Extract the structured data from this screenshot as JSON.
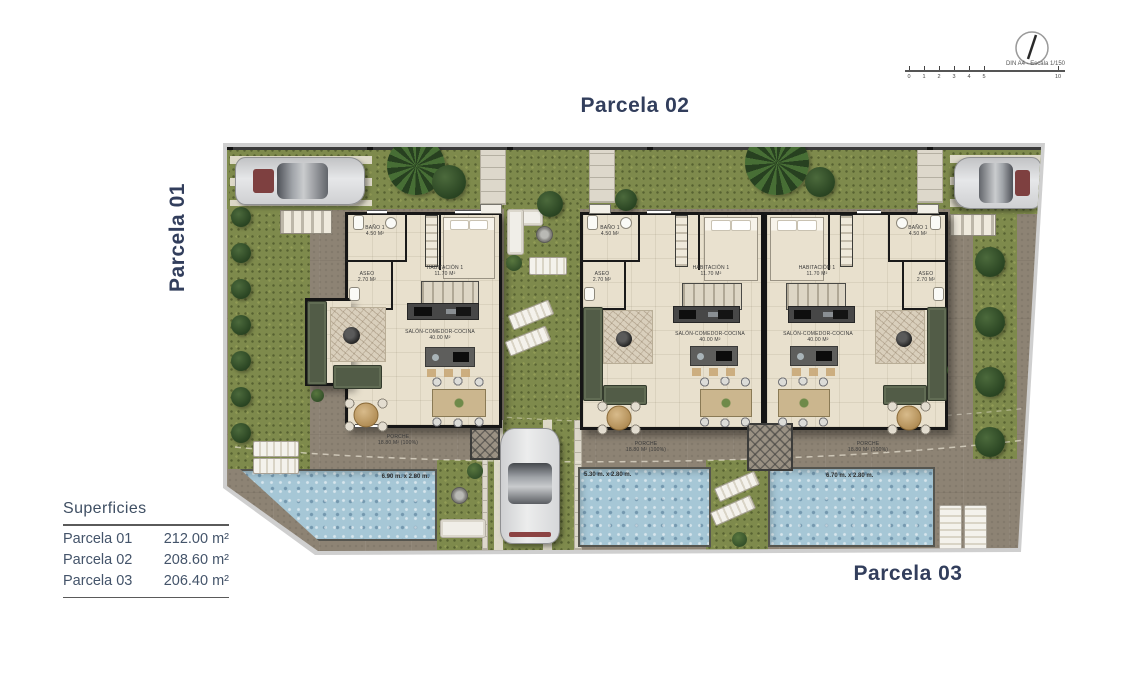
{
  "titles": {
    "parcela01": "Parcela 01",
    "parcela02": "Parcela 02",
    "parcela03": "Parcela 03"
  },
  "compass": {
    "scale_label": "DIN A4 - Escala 1/150",
    "ticks": [
      "0",
      "1",
      "2",
      "3",
      "4",
      "5"
    ],
    "tick_end": "10"
  },
  "legend": {
    "title": "Superficies",
    "rows": [
      {
        "label": "Parcela 01",
        "value": "212.00 m²"
      },
      {
        "label": "Parcela 02",
        "value": "208.60 m²"
      },
      {
        "label": "Parcela 03",
        "value": "206.40 m²"
      }
    ]
  },
  "rooms": {
    "bano_label": "BAÑO 1",
    "bano_area": "4.50 m²",
    "aseo_label": "ASEO",
    "aseo_area": "2.70 m²",
    "habitacion_label": "HABITACIÓN 1",
    "habitacion_area": "11.70 m²",
    "salon_label": "SALÓN-COMEDOR-COCINA",
    "salon_area": "40.00 m²",
    "porche_label": "PORCHE",
    "porche_area": "18.80 m² (100%)"
  },
  "pools": [
    {
      "dims": "6.90 m. x 2.80 m."
    },
    {
      "dims": "5.30 m. x 2.80 m."
    },
    {
      "dims": "6.70 m. x 2.80 m."
    }
  ],
  "colors": {
    "accent_navy": "#323e5c",
    "grass": "#7e8a4c",
    "terrace": "#8d8374",
    "pool": "#a6c7d6",
    "wall": "#161616",
    "floor": "#e8e0cd"
  }
}
